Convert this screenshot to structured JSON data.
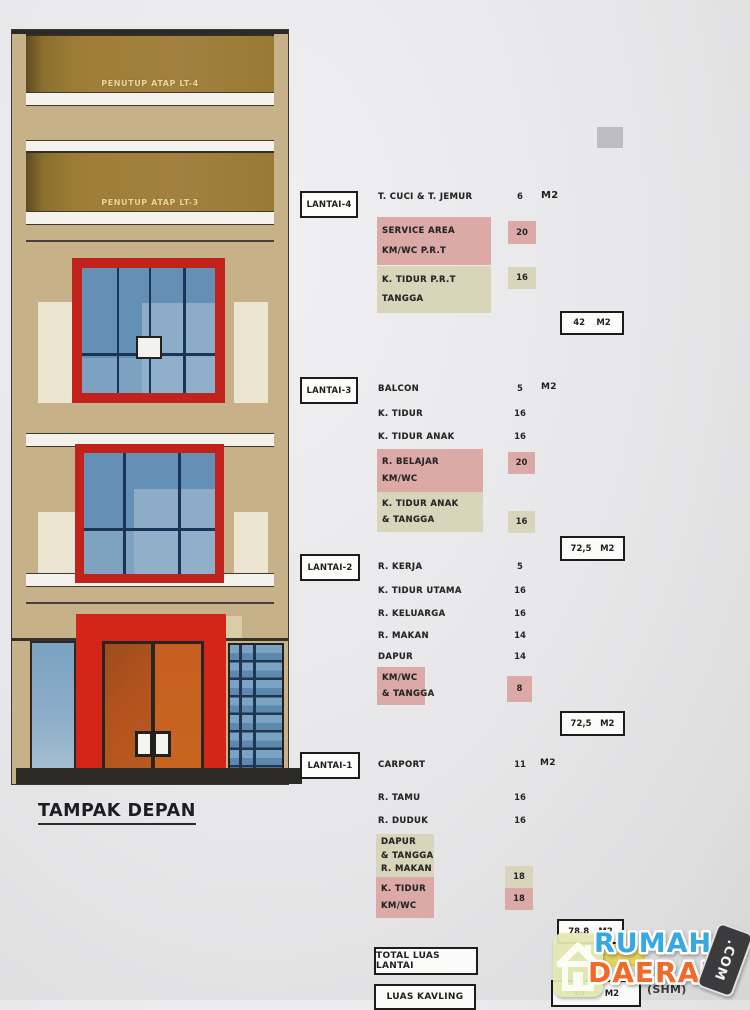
{
  "title": "TAMPAK DEPAN",
  "building": {
    "roof_lt4": "PENUTUP ATAP LT-4",
    "roof_lt3": "PENUTUP ATAP LT-3"
  },
  "lantai4": {
    "label": "LANTAI-4",
    "rows": [
      {
        "label": "T. CUCI & T. JEMUR",
        "value": "6",
        "unit": "M2"
      }
    ],
    "pink_box": {
      "line1": "SERVICE AREA",
      "line2": "KM/WC P.R.T",
      "value": "20"
    },
    "beige_box": {
      "line1": "K. TIDUR P.R.T",
      "line2": "TANGGA",
      "value": "16"
    },
    "total": {
      "value": "42",
      "unit": "M2"
    }
  },
  "lantai3": {
    "label": "LANTAI-3",
    "rows": [
      {
        "label": "BALCON",
        "value": "5",
        "unit": "M2"
      },
      {
        "label": "K. TIDUR",
        "value": "16"
      },
      {
        "label": "K. TIDUR ANAK",
        "value": "16"
      }
    ],
    "pink_box": {
      "line1": "R. BELAJAR",
      "line2": "KM/WC",
      "value": "20"
    },
    "beige_box": {
      "line1": "K. TIDUR ANAK",
      "line2": "& TANGGA",
      "value": "16"
    },
    "total": {
      "value": "72,5",
      "unit": "M2"
    }
  },
  "lantai2": {
    "label": "LANTAI-2",
    "rows": [
      {
        "label": "R. KERJA",
        "value": "5"
      },
      {
        "label": "K. TIDUR UTAMA",
        "value": "16"
      },
      {
        "label": "R. KELUARGA",
        "value": "16"
      },
      {
        "label": "R. MAKAN",
        "value": "14"
      },
      {
        "label": "DAPUR",
        "value": "14"
      }
    ],
    "pink_box": {
      "line1": "KM/WC",
      "line2": "& TANGGA",
      "value": "8"
    },
    "total": {
      "value": "72,5",
      "unit": "M2"
    }
  },
  "lantai1": {
    "label": "LANTAI-1",
    "rows": [
      {
        "label": "CARPORT",
        "value": "11",
        "unit": "M2"
      },
      {
        "label": "R. TAMU",
        "value": "16"
      },
      {
        "label": "R. DUDUK",
        "value": "16"
      }
    ],
    "combo_box": {
      "beige_lines": [
        "DAPUR",
        "& TANGGA",
        "R. MAKAN"
      ],
      "pink_lines": [
        "K. TIDUR",
        "KM/WC"
      ],
      "beige_value": "18",
      "pink_value": "18"
    },
    "total": {
      "value": "78,8",
      "unit": "M2"
    }
  },
  "summary": {
    "total_label": "TOTAL LUAS LANTAI",
    "kavling_label": "LUAS KAVLING",
    "kavling_value": "90",
    "kavling_unit": "M2",
    "kavling_note": "(SHM)"
  },
  "watermark": {
    "word1": "RUMAH",
    "word2": "DAERAH",
    "tag": ".COM"
  },
  "colors": {
    "table_pink": "#dcaaa6",
    "table_beige": "#d9d5ba",
    "window_frame_red": "#c1221b",
    "door_red": "#d3261b",
    "door_orange": "#c65f22",
    "wall_tan": "#c7b189",
    "roof_brown": "#9d7d36",
    "glass_blue": "#6490b6",
    "watermark_blue": "#36a9e1",
    "watermark_orange": "#f26a2a",
    "highlight_yellow": "#e5d04b"
  }
}
